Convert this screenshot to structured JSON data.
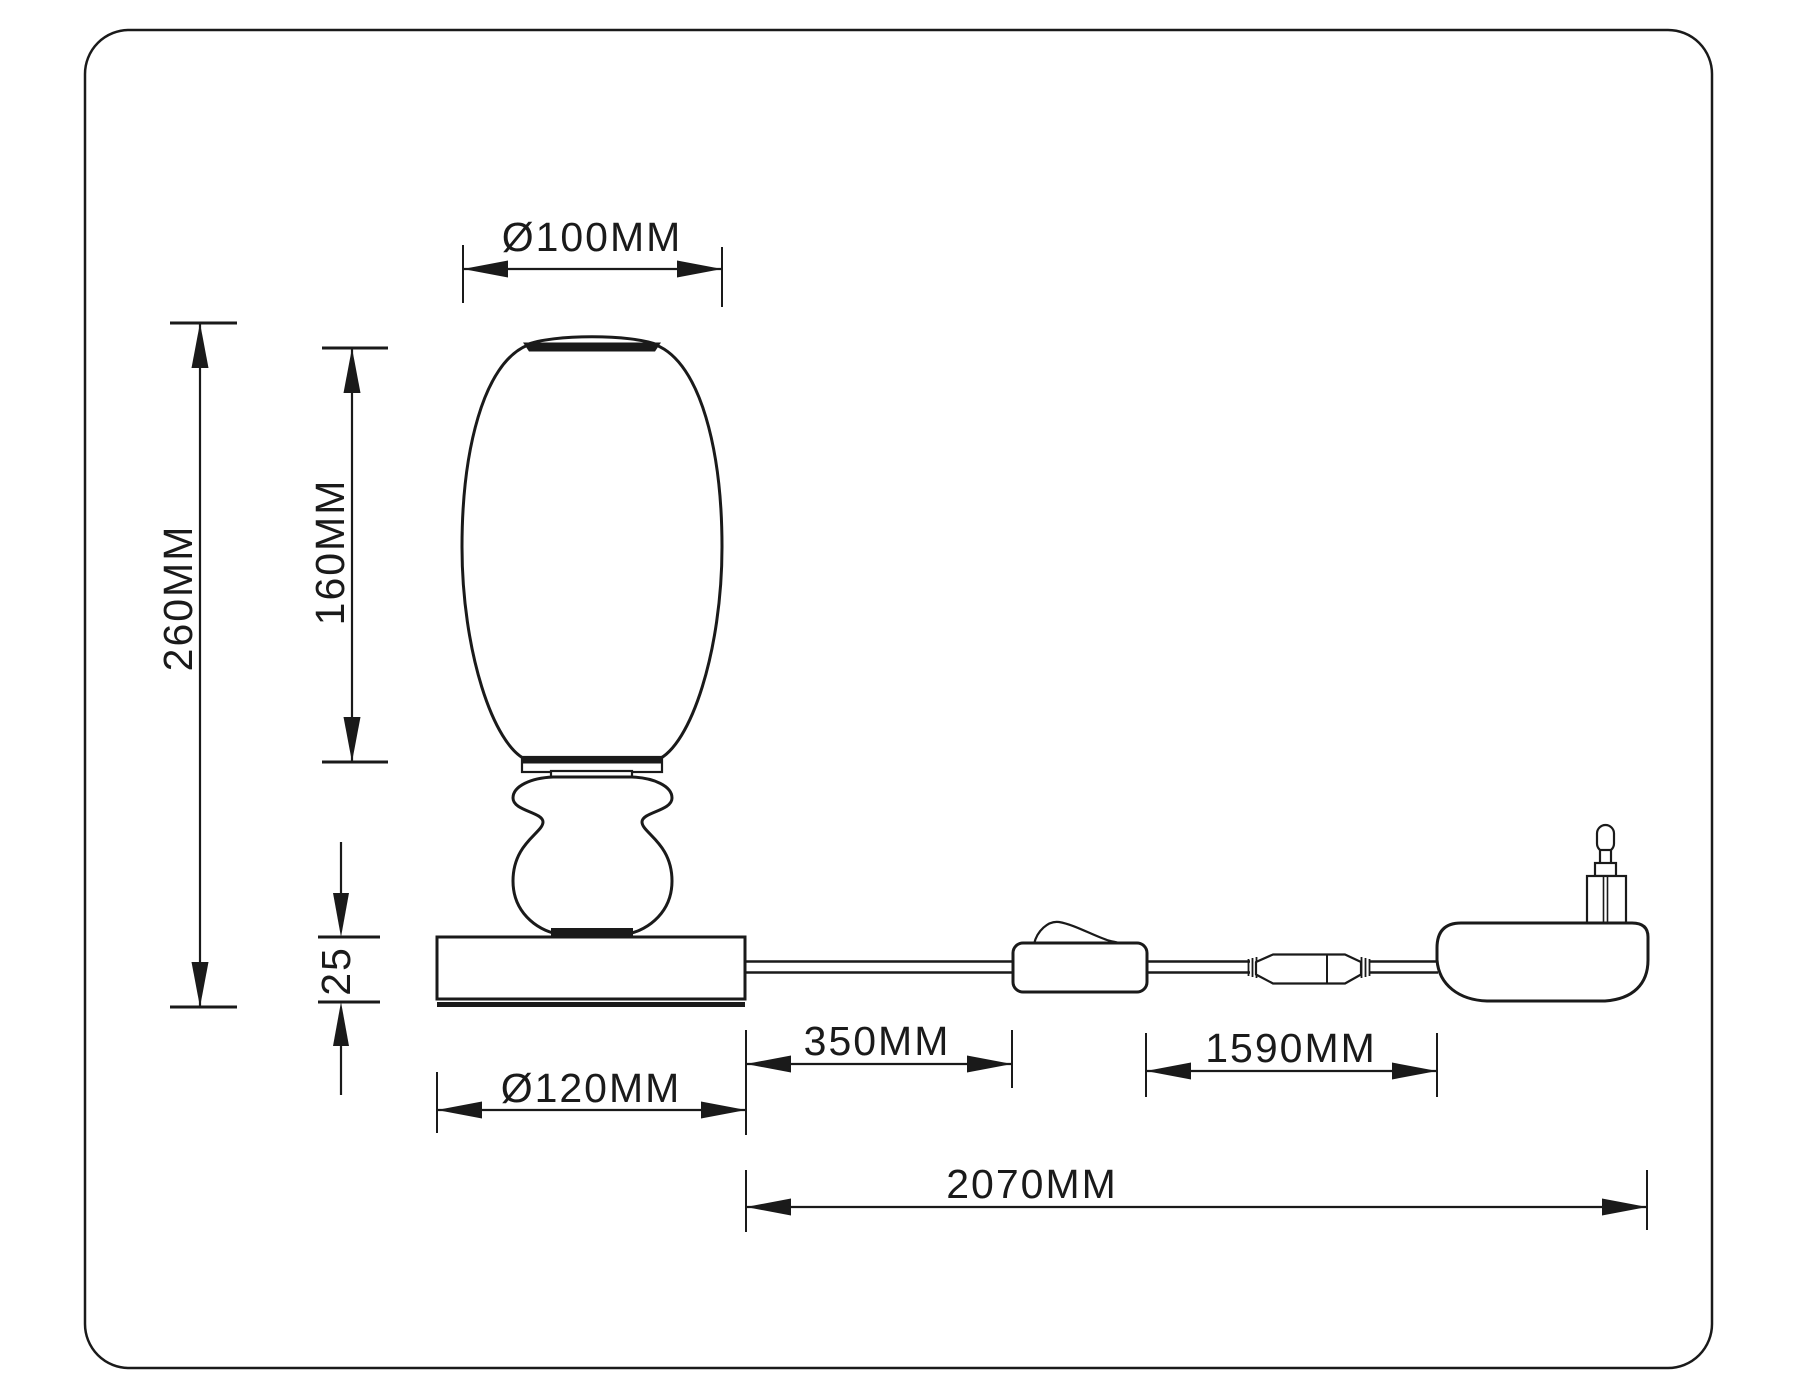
{
  "drawing": {
    "background_color": "#ffffff",
    "line_color": "#1a1a1a",
    "dimensions": {
      "shade_top_diameter": "Ø100MM",
      "shade_height": "160MM",
      "total_height": "260MM",
      "base_height": "25",
      "base_diameter": "Ø120MM",
      "cord_base_to_switch": "350MM",
      "cord_switch_to_plug": "1590MM",
      "cord_total_length": "2070MM"
    }
  }
}
